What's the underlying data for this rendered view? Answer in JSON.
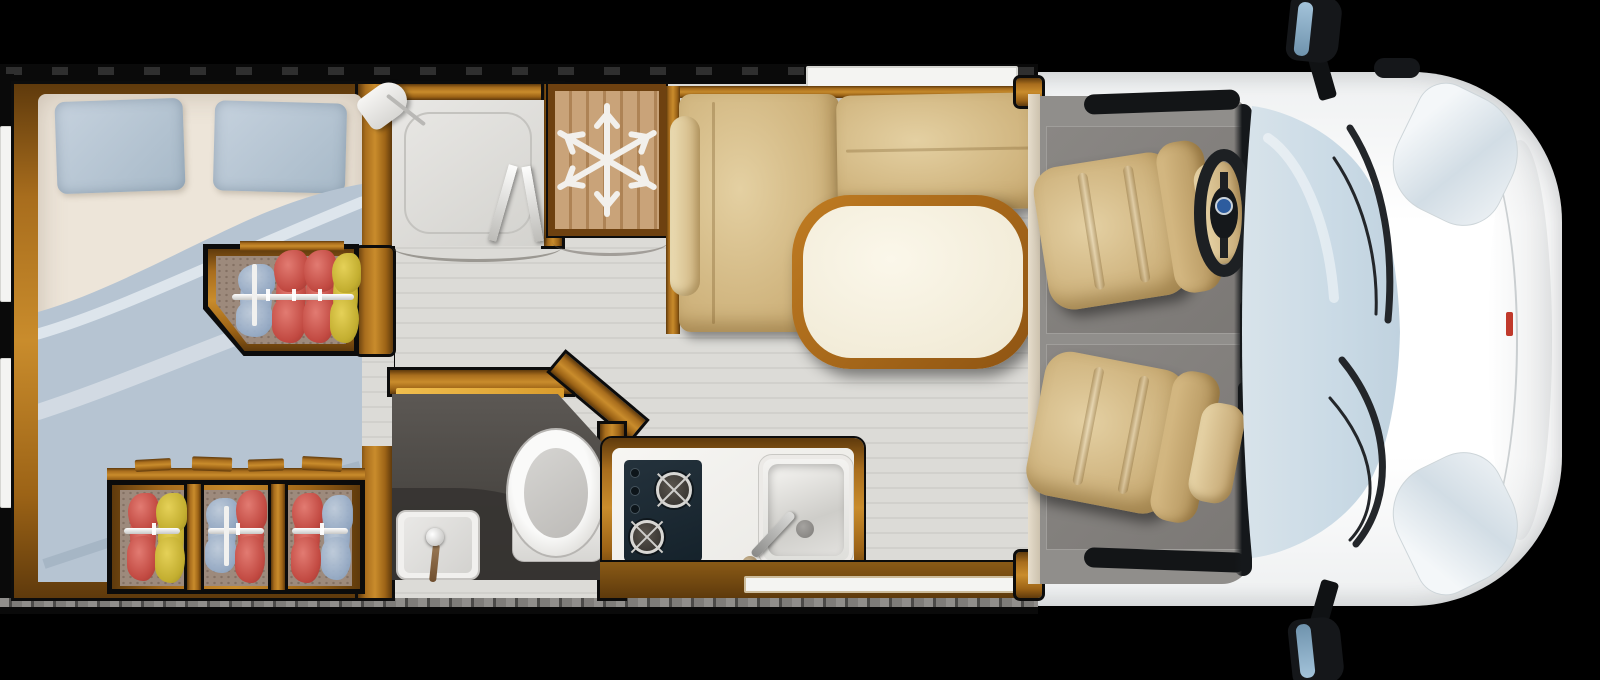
{
  "meta": {
    "title": "Motorhome floor plan - top view illustration",
    "type": "floorplan-illustration",
    "visible_text": "none"
  },
  "palette": {
    "bg": "#000000",
    "wood_mid": "#b4771f",
    "wood_dark": "#5f3a0c",
    "floor_plank": "#dcdbd7",
    "bed_sheet": "#ede5d9",
    "duvet_blue": "#b6c4d2",
    "pillow_blue": "#b2c2d1",
    "closet_carpet": "#9d8a7c",
    "cloth_red": "#c24a42",
    "cloth_yellow": "#c3ae30",
    "cloth_blue": "#97aecb",
    "seat_tan": "#d2b480",
    "table_top": "#f8f3e4",
    "table_rim": "#a9671a",
    "fridge_wood": "#c49b6a",
    "snowflake_white": "#f2f0ec",
    "bath_floor": "#4a4743",
    "fixture_white": "#f1f0ee",
    "hob_navy": "#1e2c35",
    "cab_carpet": "#908e8b",
    "windshield_blue": "#cfdde8",
    "body_white": "#fbfbfb",
    "wiper_dark": "#23262a",
    "mirror_glass": "#84a9c6",
    "badge_blue": "#2d5c9e",
    "badge_red": "#c0392b",
    "rail_white": "#f6f6f4"
  },
  "legend": {
    "areas": [
      "rear-bedroom",
      "mid-wardrobe",
      "under-bed-wardrobes",
      "shower",
      "fridge",
      "dinette",
      "bathroom",
      "kitchen",
      "cab"
    ],
    "fixtures": {
      "bedroom": [
        "double-bed",
        "pillow-left",
        "pillow-right",
        "duvet",
        "hanging-rail-wardrobe",
        "three-compartment-wardrobe",
        "two-rear-windows"
      ],
      "shower": [
        "shower-tray",
        "shower-head",
        "bifold-glass-door",
        "sliding-door-arc"
      ],
      "fridge": [
        "snowflake-symbol",
        "door-swing-arc"
      ],
      "dinette": [
        "l-shaped-bench",
        "armrest",
        "backrest",
        "oval-table",
        "window-above-bench"
      ],
      "bathroom": [
        "toilet",
        "washbasin",
        "faucet",
        "open-door",
        "chamfered-wall"
      ],
      "kitchen": [
        "two-burner-hob",
        "three-control-knobs",
        "square-sink",
        "swivel-faucet",
        "entry-door-window"
      ],
      "cab": [
        "driver-swivel-seat",
        "passenger-swivel-seat",
        "steering-wheel",
        "steering-badge",
        "dashboard",
        "windshield",
        "wiper-left",
        "wiper-right",
        "headlight-top",
        "headlight-bottom",
        "mirror-top",
        "mirror-bottom",
        "antenna",
        "front-red-badge"
      ]
    }
  }
}
